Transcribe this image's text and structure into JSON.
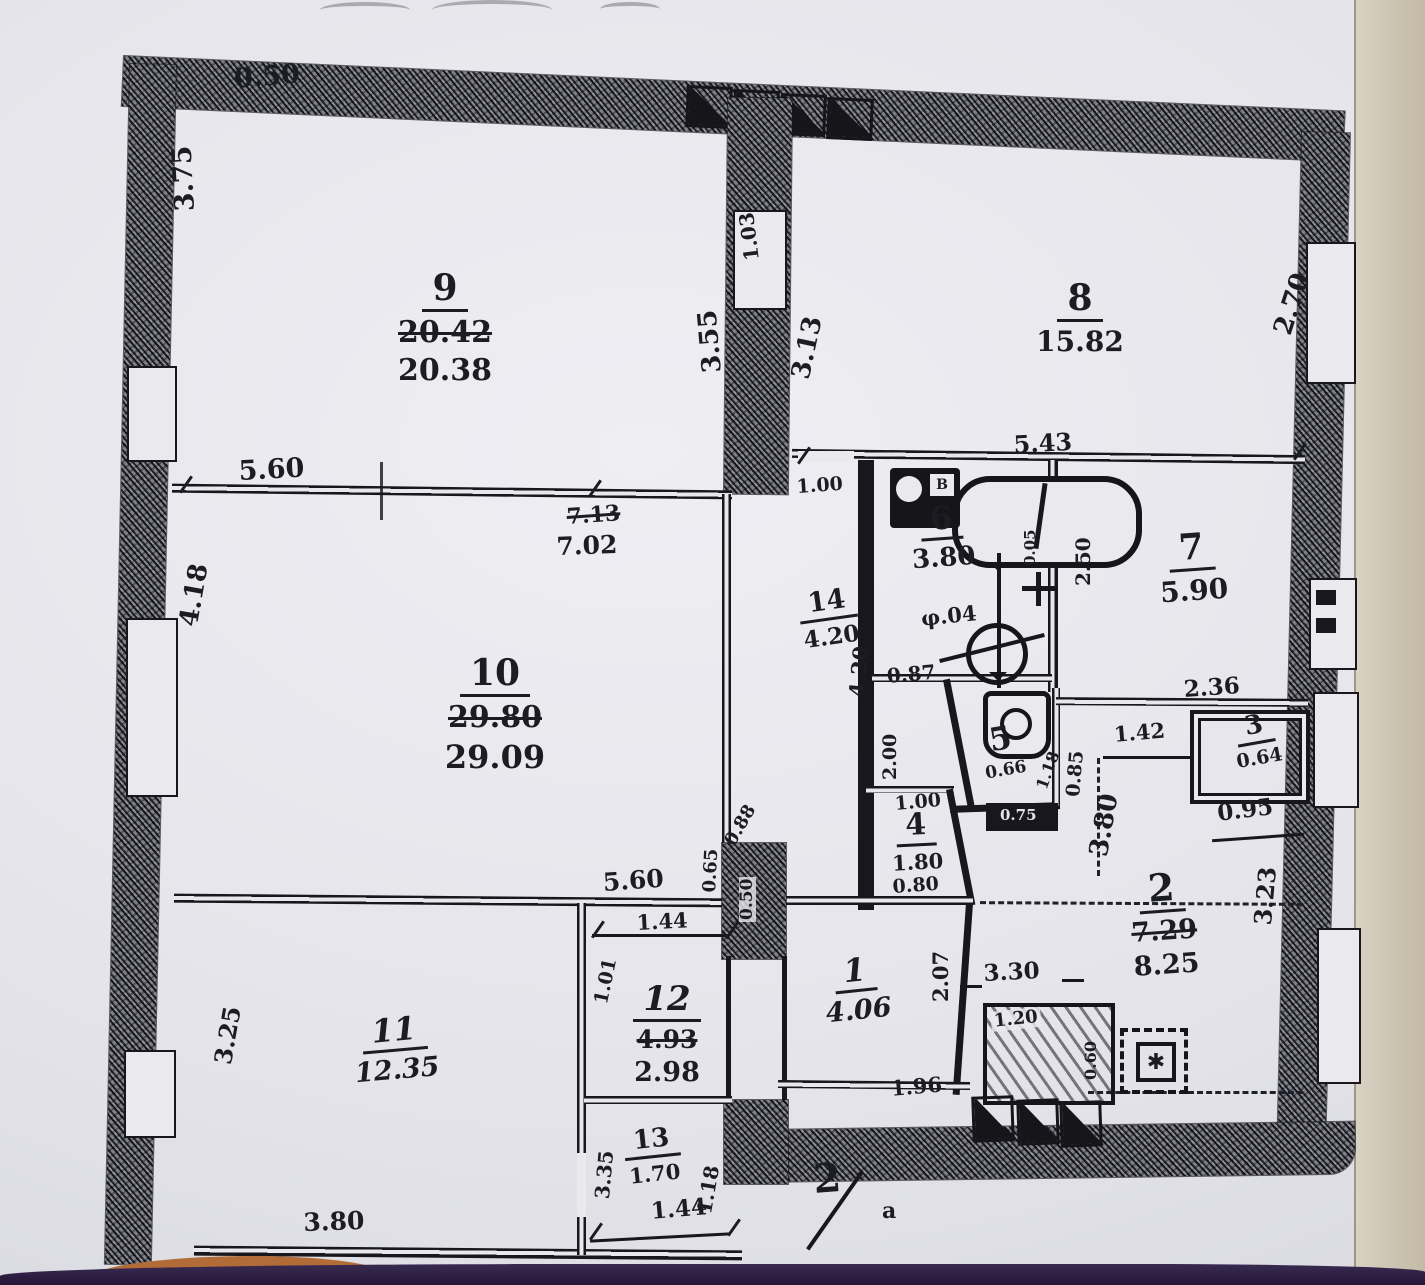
{
  "rooms": [
    {
      "number": "9",
      "area_crossed": "20.42",
      "area": "20.38"
    },
    {
      "number": "8",
      "area": "15.82"
    },
    {
      "number": "10",
      "area_crossed": "29.80",
      "area": "29.09"
    },
    {
      "number": "14",
      "area": "4.20"
    },
    {
      "number": "6",
      "area": "3.80"
    },
    {
      "number": "7",
      "area": "5.90"
    },
    {
      "number": "5",
      "area": "0.66"
    },
    {
      "number": "3",
      "area": "0.64"
    },
    {
      "number": "4",
      "area": "1.80"
    },
    {
      "number": "2",
      "area_crossed": "7.29",
      "area": "8.25"
    },
    {
      "number": "1",
      "area": "4.06"
    },
    {
      "number": "12",
      "area_crossed": "4.93",
      "area": "2.98"
    },
    {
      "number": "11",
      "area": "12.35"
    },
    {
      "number": "13",
      "area": "1.70"
    }
  ],
  "dimensions": {
    "top_width": "0.50",
    "left_upper_height": "3.75",
    "partition_left": "3.55",
    "partition_door": "1.03",
    "partition_right": "3.13",
    "right_window": "2.70",
    "room9_bottom_width": "5.60",
    "room10_top_crossed": "7.13",
    "room10_top": "7.02",
    "left_mid_height": "4.18",
    "room8_bottom_width": "5.43",
    "hall_opening": "1.00",
    "bath_offset": "0.05",
    "room7_left_height": "2.50",
    "meter_dia": "φ.04",
    "bath_bottom": "0.87",
    "corridor_height": "4.20",
    "room7_bottom": "2.36",
    "hall_width": "1.42",
    "wc_right": "1.18",
    "wc_left": "0.85",
    "wc_bottom": "0.75",
    "room2_height_left": "3.80",
    "room3_bottom": "0.95",
    "room2_right_height": "3.23",
    "room4_left_height": "2.00",
    "room4_top": "1.00",
    "room4_bottom": "0.80",
    "duct_diag": "0.88",
    "duct_left": "0.65",
    "duct_inner": "0.50",
    "room11_top_width": "5.60",
    "room12_top": "1.44",
    "room12_left": "1.01",
    "room1_right_height": "2.07",
    "balcony_width": "3.30",
    "balcony_depth": "1.20",
    "balcony_side": "0.60",
    "room1_bottom": "1.96",
    "room11_left_height": "3.25",
    "room11_bottom_width": "3.80",
    "room13_left": "3.35",
    "room13_right": "1.18",
    "room13_bottom": "1.44"
  },
  "annotations": {
    "basin_mark": "B",
    "stove_mark": "✱",
    "sheet_number": "2",
    "sheet_suffix": "a"
  }
}
